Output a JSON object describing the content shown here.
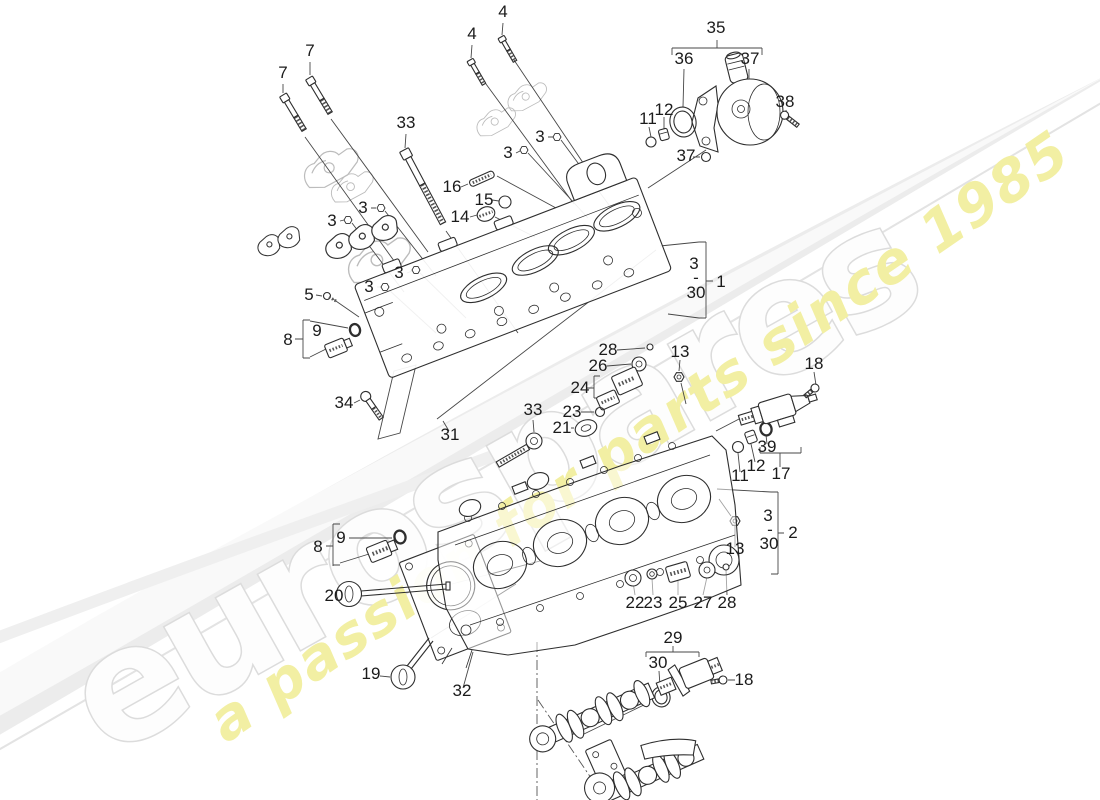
{
  "watermark": {
    "brand": "eurospares",
    "tagline": "a passion for parts since 1985",
    "brand_fill": "#fdfdfd",
    "brand_outline": "#dcdcdc",
    "tagline_color": "#f2efa3",
    "swoosh_color": "#ececec"
  },
  "diagram": {
    "line_color": "#2e2e2e",
    "ghost_color": "#bcbcbc",
    "label_color": "#1b1b1b",
    "background": "#ffffff"
  },
  "labels": [
    {
      "text": "7",
      "x": 283,
      "y": 78
    },
    {
      "text": "7",
      "x": 310,
      "y": 56
    },
    {
      "text": "4",
      "x": 472,
      "y": 39
    },
    {
      "text": "4",
      "x": 503,
      "y": 17
    },
    {
      "text": "33",
      "x": 406,
      "y": 128
    },
    {
      "text": "3",
      "x": 540,
      "y": 142
    },
    {
      "text": "3",
      "x": 508,
      "y": 158
    },
    {
      "text": "16",
      "x": 452,
      "y": 192
    },
    {
      "text": "15",
      "x": 484,
      "y": 205
    },
    {
      "text": "14",
      "x": 460,
      "y": 222
    },
    {
      "text": "3",
      "x": 363,
      "y": 213
    },
    {
      "text": "3",
      "x": 332,
      "y": 226
    },
    {
      "text": "35",
      "x": 716,
      "y": 33
    },
    {
      "text": "36",
      "x": 684,
      "y": 64
    },
    {
      "text": "37",
      "x": 750,
      "y": 64
    },
    {
      "text": "12",
      "x": 664,
      "y": 115
    },
    {
      "text": "11",
      "x": 648,
      "y": 124
    },
    {
      "text": "38",
      "x": 785,
      "y": 107
    },
    {
      "text": "37",
      "x": 686,
      "y": 161
    },
    {
      "text": "3",
      "x": 399,
      "y": 278
    },
    {
      "text": "3",
      "x": 369,
      "y": 292
    },
    {
      "text": "5",
      "x": 309,
      "y": 300
    },
    {
      "text": "9",
      "x": 317,
      "y": 336
    },
    {
      "text": "8",
      "x": 288,
      "y": 345
    },
    {
      "text": "34",
      "x": 344,
      "y": 408
    },
    {
      "text": "31",
      "x": 450,
      "y": 440
    },
    {
      "text": "3",
      "x": 694,
      "y": 269
    },
    {
      "text": "-",
      "x": 696,
      "y": 283
    },
    {
      "text": "30",
      "x": 696,
      "y": 298
    },
    {
      "text": "1",
      "x": 721,
      "y": 287
    },
    {
      "text": "28",
      "x": 608,
      "y": 355
    },
    {
      "text": "26",
      "x": 598,
      "y": 371
    },
    {
      "text": "24",
      "x": 580,
      "y": 393
    },
    {
      "text": "23",
      "x": 572,
      "y": 417
    },
    {
      "text": "21",
      "x": 562,
      "y": 433
    },
    {
      "text": "33",
      "x": 533,
      "y": 415
    },
    {
      "text": "13",
      "x": 680,
      "y": 357
    },
    {
      "text": "18",
      "x": 814,
      "y": 369
    },
    {
      "text": "39",
      "x": 767,
      "y": 452
    },
    {
      "text": "12",
      "x": 756,
      "y": 471
    },
    {
      "text": "11",
      "x": 740,
      "y": 481
    },
    {
      "text": "17",
      "x": 781,
      "y": 479
    },
    {
      "text": "3",
      "x": 768,
      "y": 521
    },
    {
      "text": "-",
      "x": 770,
      "y": 535
    },
    {
      "text": "30",
      "x": 769,
      "y": 549
    },
    {
      "text": "2",
      "x": 793,
      "y": 538
    },
    {
      "text": "13",
      "x": 735,
      "y": 554
    },
    {
      "text": "8",
      "x": 318,
      "y": 552
    },
    {
      "text": "9",
      "x": 341,
      "y": 543
    },
    {
      "text": "20",
      "x": 334,
      "y": 601
    },
    {
      "text": "19",
      "x": 371,
      "y": 679
    },
    {
      "text": "32",
      "x": 462,
      "y": 696
    },
    {
      "text": "22",
      "x": 635,
      "y": 608
    },
    {
      "text": "23",
      "x": 653,
      "y": 608
    },
    {
      "text": "25",
      "x": 678,
      "y": 608
    },
    {
      "text": "27",
      "x": 703,
      "y": 608
    },
    {
      "text": "28",
      "x": 727,
      "y": 608
    },
    {
      "text": "29",
      "x": 673,
      "y": 643
    },
    {
      "text": "30",
      "x": 658,
      "y": 668
    },
    {
      "text": "18",
      "x": 744,
      "y": 685
    }
  ]
}
